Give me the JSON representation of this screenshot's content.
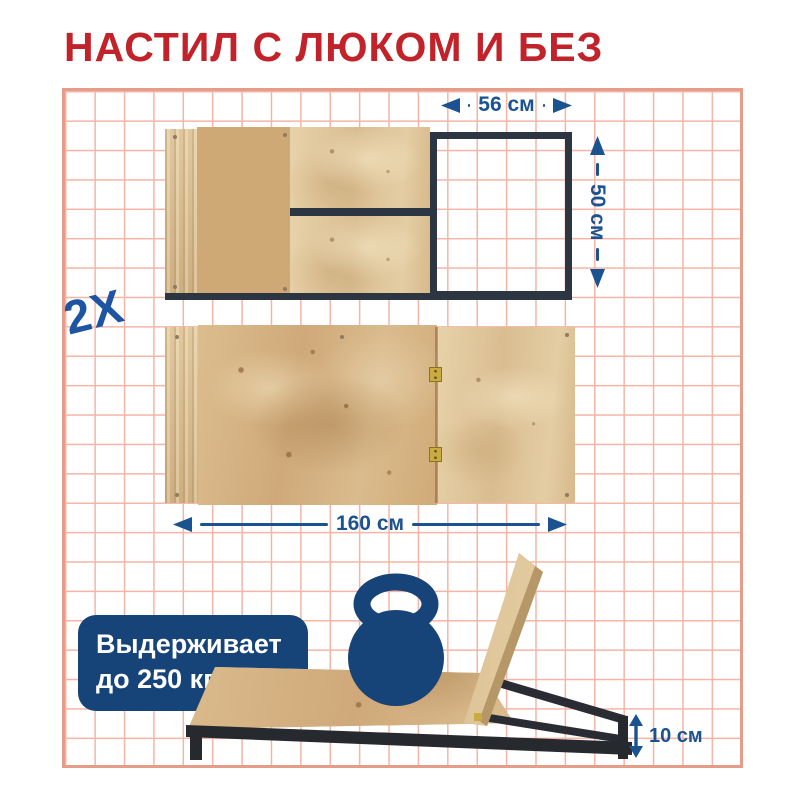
{
  "title": "НАСТИЛ С ЛЮКОМ И БЕЗ",
  "multiplier": "2X",
  "dims": {
    "hatch_width": "56 см",
    "hatch_depth": "50 см",
    "deck_length": "160 см",
    "frame_height": "10 см"
  },
  "badge": {
    "line1": "Выдерживает",
    "line2": "до 250 кг"
  },
  "icons": {
    "kettlebell": "kettlebell-icon"
  },
  "colors": {
    "title_red": "#c2232a",
    "accent_blue": "#1b5391",
    "navy": "#174478",
    "grid_line": "#f4b5a6",
    "grid_border": "#e59c88",
    "metal": "#2b3642",
    "wood": "#d6b383"
  }
}
